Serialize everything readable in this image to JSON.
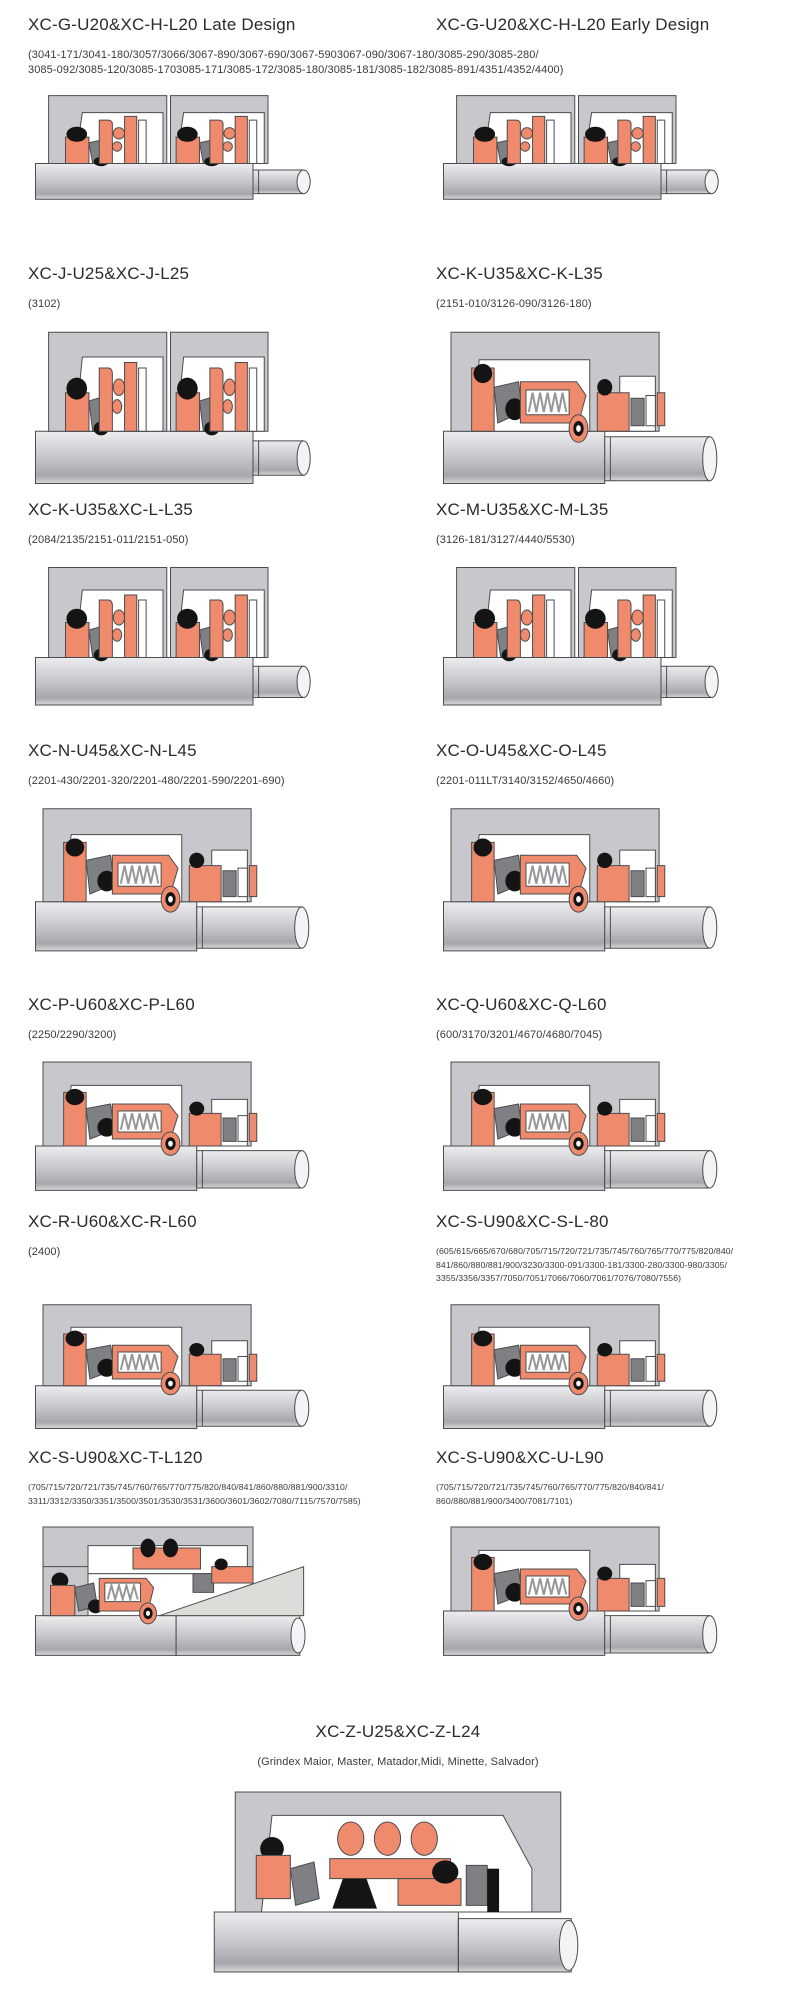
{
  "page": {
    "background": "#ffffff"
  },
  "diagram_palette": {
    "housing": "#c8c8cc",
    "seal": "#f08a6c",
    "black": "#141414",
    "face": "#7e8084",
    "outline": "#4b4c4e",
    "white": "#ffffff",
    "casing": "#dcdcd8",
    "spring": "#96979b",
    "shaft_hi": "#ededf0",
    "shaft_mid": "#c6c7cb",
    "shaft_lo": "#a6a7ab",
    "shaft_edge": "#d8d8da",
    "shaft_end": "#f4f4f6"
  },
  "sections": [
    {
      "title": "XC-G-U20&XC-H-L20 Late Design",
      "subtitle_lines": [
        "(3041-171/3041-180/3057/3066/3067-890/3067-690/3067-5903067-090/3067-180/3085-290/3085-280/",
        "3085-092/3085-120/3085-1703085-171/3085-172/3085-180/3085-181/3085-182/3085-891/4351/4352/4400)"
      ]
    },
    {
      "title": "XC-G-U20&XC-H-L20 Early Design",
      "subtitle_lines": []
    },
    {
      "title": "XC-J-U25&XC-J-L25",
      "subtitle_lines": [
        "(3102)"
      ]
    },
    {
      "title": "XC-K-U35&XC-K-L35",
      "subtitle_lines": [
        "(2151-010/3126-090/3126-180)"
      ]
    },
    {
      "title": "XC-K-U35&XC-L-L35",
      "subtitle_lines": [
        "(2084/2135/2151-011/2151-050)"
      ]
    },
    {
      "title": "XC-M-U35&XC-M-L35",
      "subtitle_lines": [
        "(3126-181/3127/4440/5530)"
      ]
    },
    {
      "title": "XC-N-U45&XC-N-L45",
      "subtitle_lines": [
        "(2201-430/2201-320/2201-480/2201-590/2201-690)"
      ]
    },
    {
      "title": "XC-O-U45&XC-O-L45",
      "subtitle_lines": [
        "(2201-011LT/3140/3152/4650/4660)"
      ]
    },
    {
      "title": "XC-P-U60&XC-P-L60",
      "subtitle_lines": [
        "(2250/2290/3200)"
      ]
    },
    {
      "title": "XC-Q-U60&XC-Q-L60",
      "subtitle_lines": [
        "(600/3170/3201/4670/4680/7045)"
      ]
    },
    {
      "title": "XC-R-U60&XC-R-L60",
      "subtitle_lines": [
        "(2400)"
      ]
    },
    {
      "title": "XC-S-U90&XC-S-L-80",
      "subtitle_lines": [
        "(605/615/665/670/680/705/715/720/721/735/745/760/765/770/775/820/840/",
        "841/860/880/881/900/3230/3300-091/3300-181/3300-280/3300-980/3305/",
        "3355/3356/3357/7050/7051/7066/7060/7061/7076/7080/7556)"
      ]
    },
    {
      "title": "XC-S-U90&XC-T-L120",
      "subtitle_lines": [
        "(705/715/720/721/735/745/760/765/770/775/820/840/841/860/880/881/900/3310/",
        "3311/3312/3350/3351/3500/3501/3530/3531/3600/3601/3602/7080/7115/7570/7585)"
      ]
    },
    {
      "title": "XC-S-U90&XC-U-L90",
      "subtitle_lines": [
        "(705/715/720/721/735/745/760/765/770/775/820/840/841/",
        "860/880/881/900/3400/7081/7101)"
      ]
    },
    {
      "title": "XC-Z-U25&XC-Z-L24",
      "subtitle_lines": [
        "(Grindex  Maior, Master, Matador,Midi, Minette, Salvador)"
      ]
    }
  ]
}
